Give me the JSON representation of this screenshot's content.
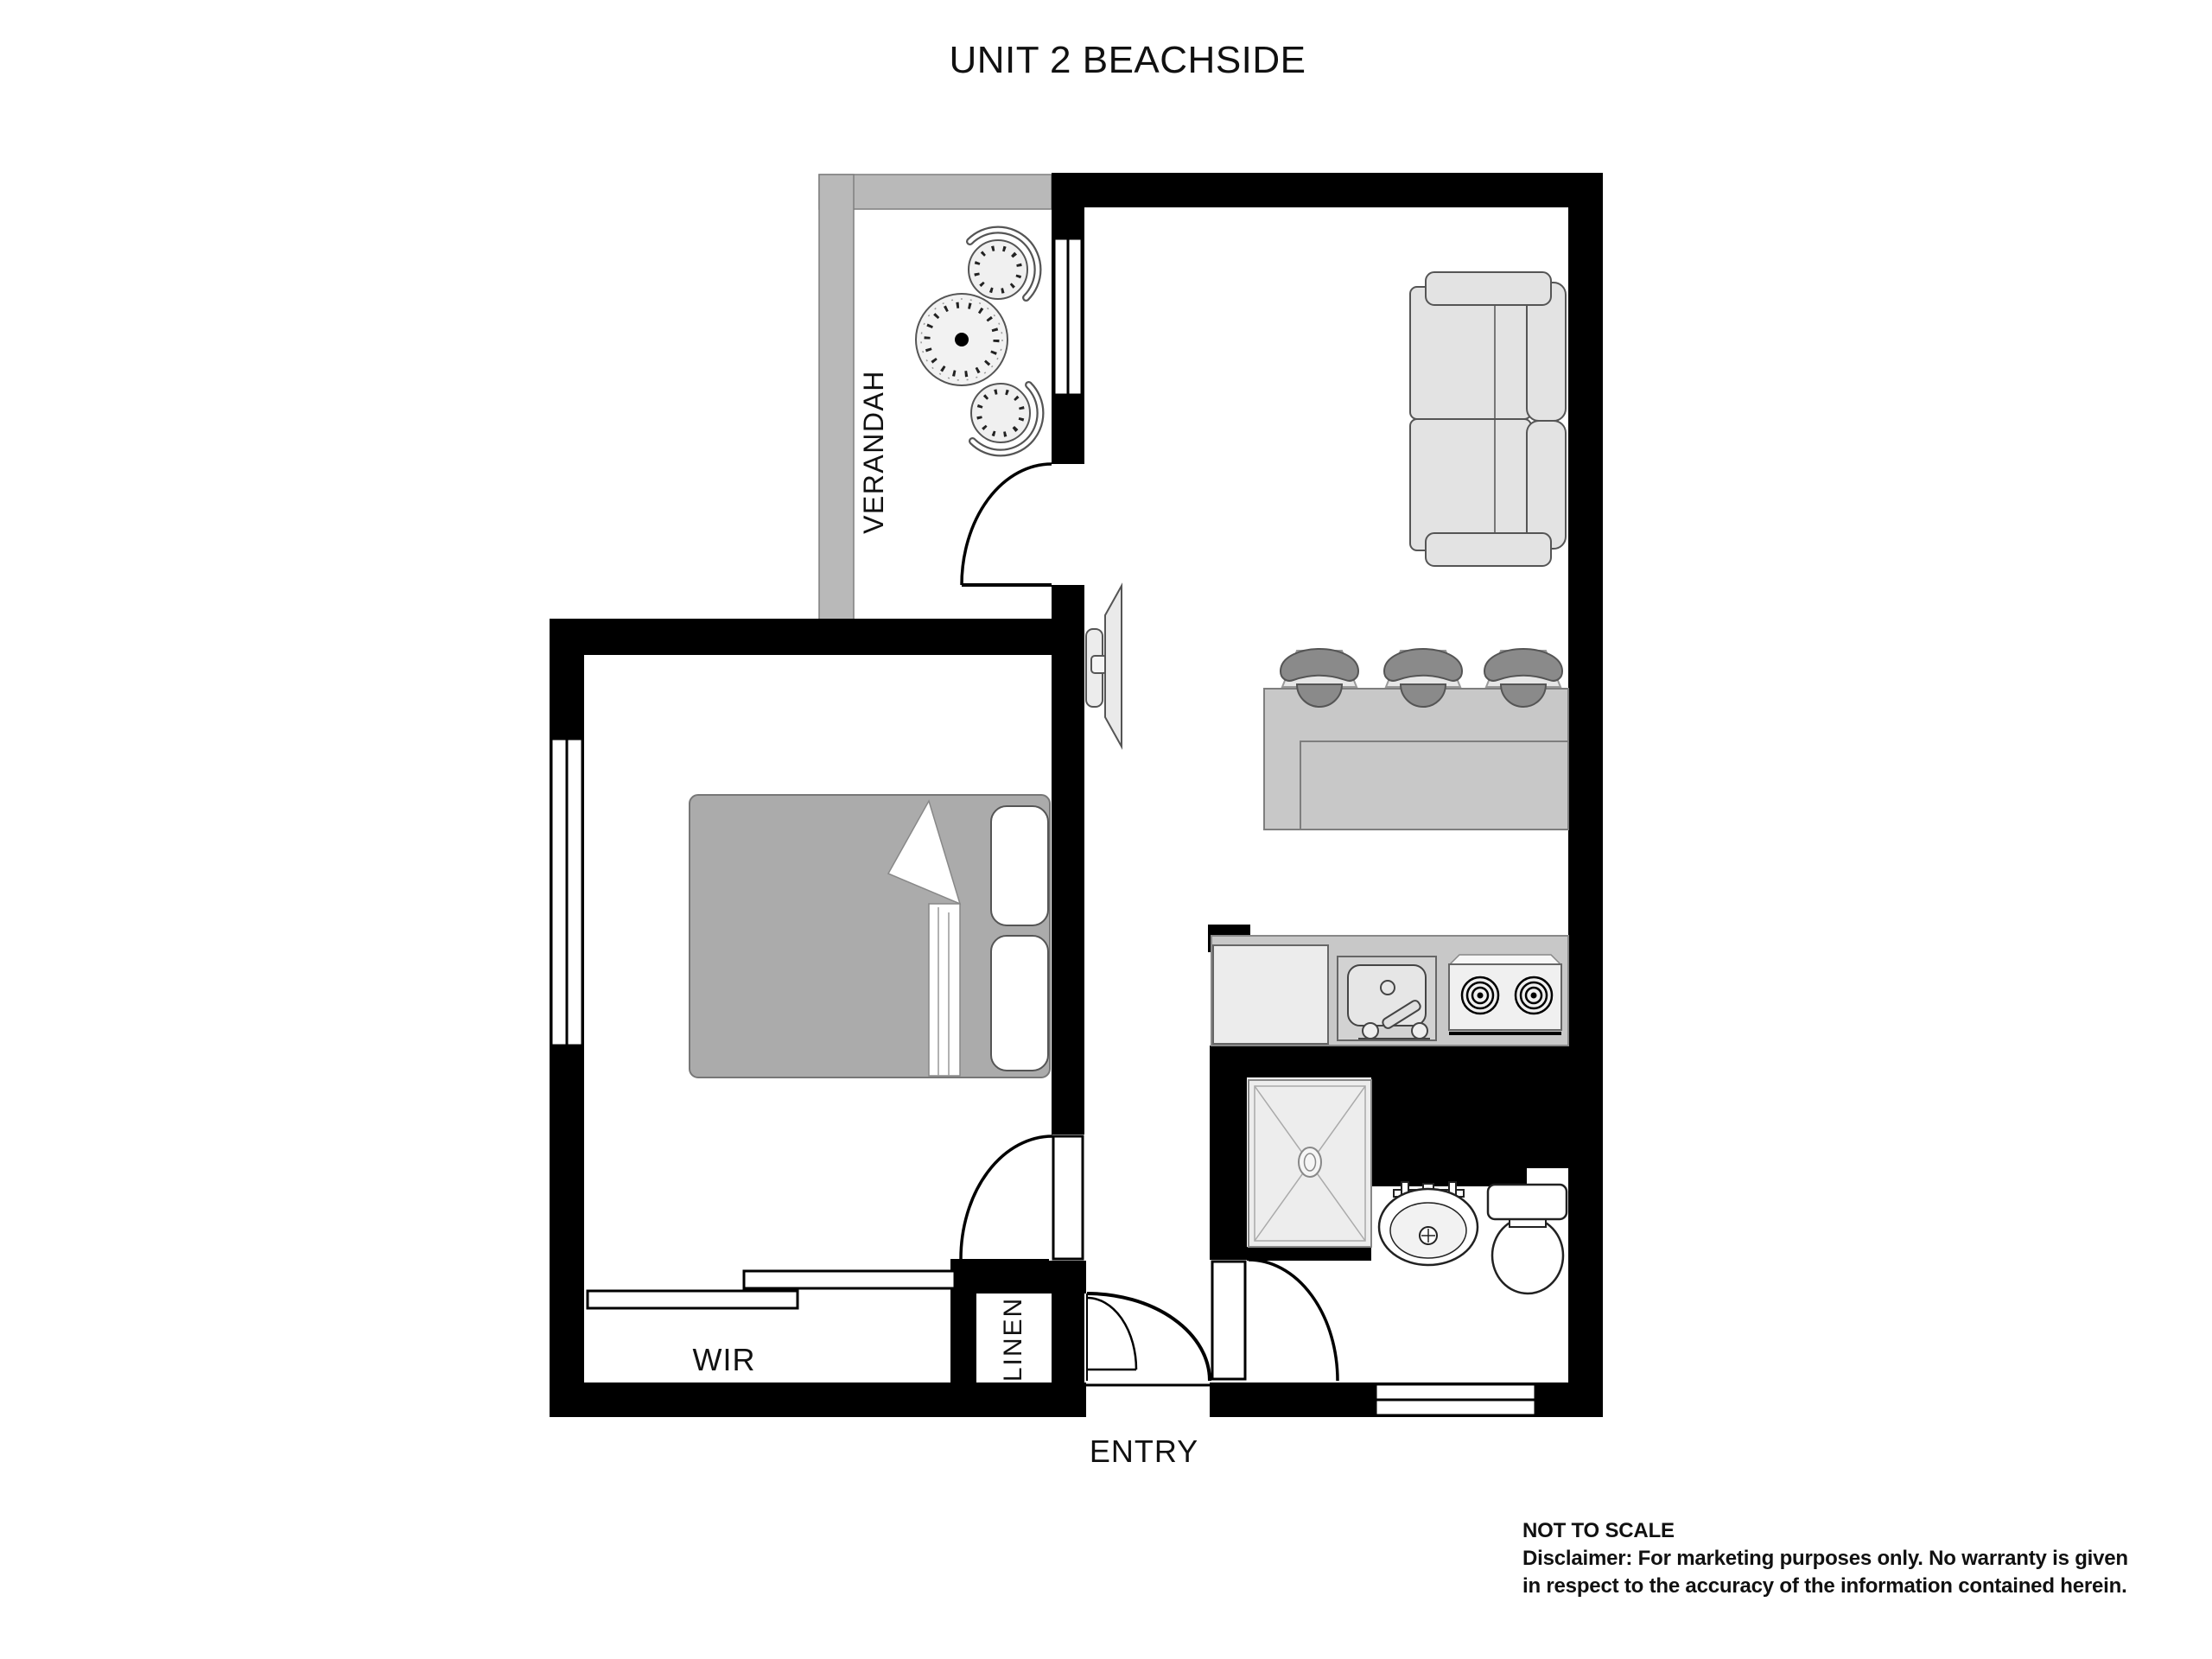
{
  "title": "UNIT 2 BEACHSIDE",
  "rooms": {
    "verandah": {
      "label": "VERANDAH"
    },
    "wir": {
      "label": "WIR"
    },
    "linen": {
      "label": "LINEN"
    },
    "entry": {
      "label": "ENTRY"
    }
  },
  "footer": {
    "not_to_scale": "NOT TO SCALE",
    "disclaimer_line1": "Disclaimer: For marketing purposes only.  No warranty is given",
    "disclaimer_line2": "in respect to the accuracy of the information contained herein."
  },
  "colors": {
    "wall": "#000000",
    "verandah_wall": "#b9b9b9",
    "counter": "#c8c8c8",
    "furniture_light": "#e3e3e3",
    "appliance_light": "#ececec",
    "bed_blanket": "#ababab",
    "stool_dark": "#8a8a8a"
  }
}
